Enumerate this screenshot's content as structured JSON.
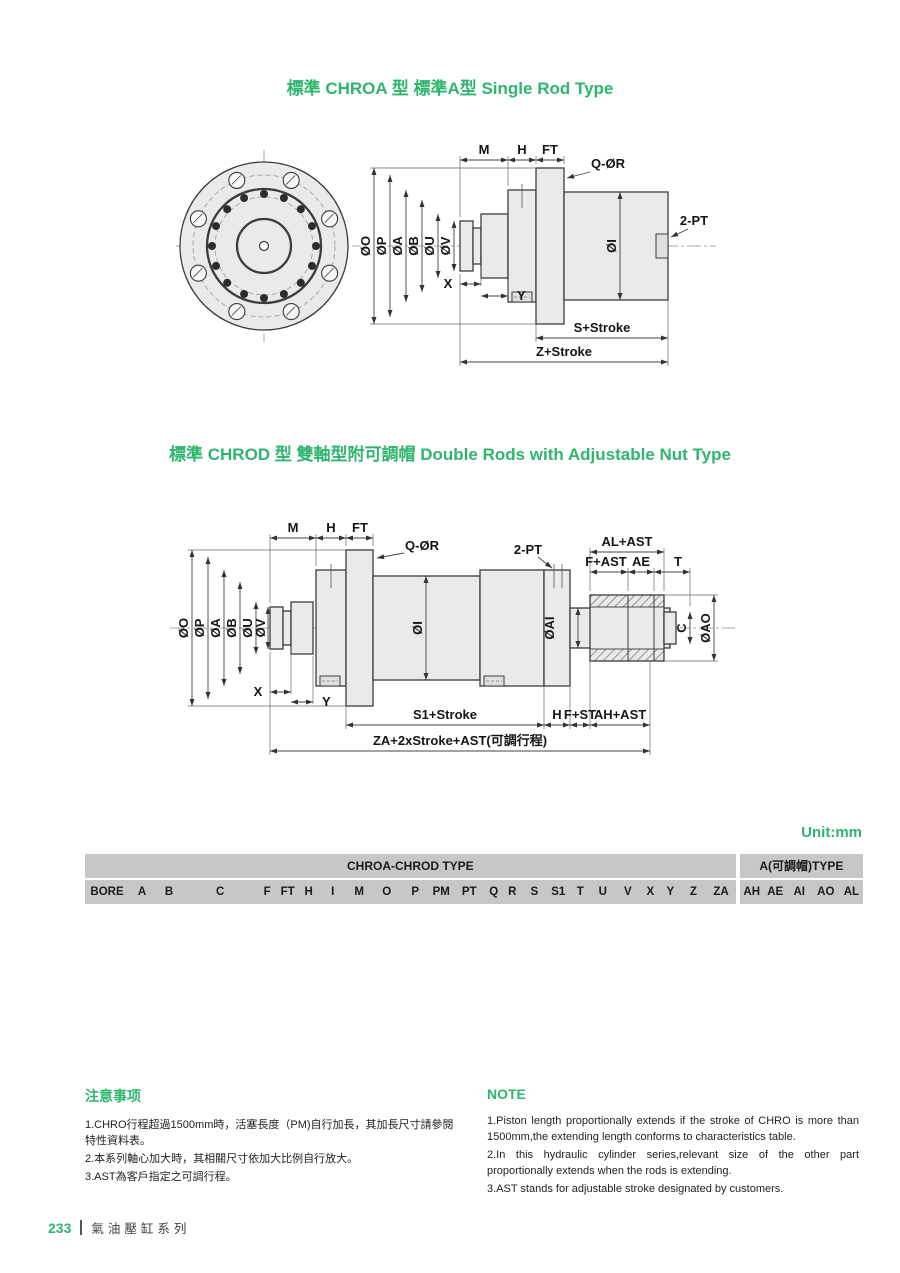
{
  "colors": {
    "accent_green": "#2fb56e",
    "table_header_bg": "#c7c7c7",
    "table_row_alt_bg": "#ebebeb"
  },
  "sections": {
    "title1": "標準 CHROA 型 標準A型 Single Rod Type",
    "title2": "標準 CHROD 型 雙軸型附可調帽 Double Rods with Adjustable Nut Type",
    "unit_label": "Unit:mm"
  },
  "drawing1": {
    "labels": {
      "m": "M",
      "h": "H",
      "ft": "FT",
      "q_or": "Q-ØR",
      "pt": "2-PT",
      "o_o": "ØO",
      "o_p": "ØP",
      "o_a": "ØA",
      "o_b": "ØB",
      "o_u": "ØU",
      "o_v": "ØV",
      "x": "X",
      "y": "Y",
      "o_i": "ØI",
      "s_stroke": "S+Stroke",
      "z_stroke": "Z+Stroke"
    }
  },
  "drawing2": {
    "labels": {
      "m": "M",
      "h": "H",
      "ft": "FT",
      "q_or": "Q-ØR",
      "pt": "2-PT",
      "al_ast": "AL+AST",
      "f_ast": "F+AST",
      "ae": "AE",
      "t": "T",
      "o_o": "ØO",
      "o_p": "ØP",
      "o_a": "ØA",
      "o_b": "ØB",
      "o_u": "ØU",
      "o_v": "ØV",
      "x": "X",
      "y": "Y",
      "o_i": "ØI",
      "o_ai": "ØAI",
      "c": "C",
      "o_ao": "ØAO",
      "s1_stroke": "S1+Stroke",
      "h_dim": "H",
      "f_st": "F+ST",
      "ah_ast": "AH+AST",
      "za_stroke": "ZA+2xStroke+AST(可調行程)"
    }
  },
  "table": {
    "group_headers": [
      "CHROA-CHROD TYPE",
      "A(可調帽)TYPE"
    ],
    "split_after": 24,
    "columns": [
      "BORE",
      "A",
      "B",
      "C",
      "F",
      "FT",
      "H",
      "I",
      "M",
      "O",
      "P",
      "PM",
      "PT",
      "Q",
      "R",
      "S",
      "S1",
      "T",
      "U",
      "V",
      "X",
      "Y",
      "Z",
      "ZA",
      "AH",
      "AE",
      "AI",
      "AO",
      "AL"
    ],
    "rows": [
      [
        "Φ125",
        "175",
        "60",
        "M50XP2.0",
        "25",
        "45",
        "50",
        "152",
        "80",
        "240",
        "210",
        "60",
        "3/4\"",
        "6",
        "18",
        "125",
        "100",
        "15",
        "60",
        "50",
        "15",
        "15",
        "255",
        "355",
        "50",
        "35",
        "70",
        "100",
        "60"
      ],
      [
        "Φ150",
        "200",
        "80",
        "M70XP2.0",
        "25",
        "50",
        "50",
        "180",
        "80",
        "280",
        "240",
        "60",
        "1\"",
        "6",
        "18",
        "130",
        "100",
        "20",
        "80",
        "70",
        "15",
        "15",
        "260",
        "365",
        "60",
        "40",
        "95",
        "120",
        "65"
      ],
      [
        "Φ180",
        "240",
        "100",
        "M90XP2.0",
        "30",
        "60",
        "60",
        "216",
        "100",
        "320",
        "280",
        "70",
        "1\"",
        "6",
        "18",
        "150",
        "110",
        "30",
        "95",
        "85",
        "25",
        "25",
        "310",
        "430",
        "70",
        "40",
        "120",
        "150",
        "70"
      ],
      [
        "Φ200",
        "260",
        "125",
        "M100XP2.0",
        "30",
        "65",
        "70",
        "242",
        "100",
        "350",
        "310",
        "70",
        "1.1/4\"",
        "6",
        "20",
        "155",
        "110",
        "30",
        "115",
        "100",
        "25",
        "25",
        "325",
        "450",
        "70",
        "40",
        "140",
        "180",
        "70"
      ],
      [
        "Φ225",
        "290",
        "140",
        "M120XP3.0",
        "30",
        "70",
        "70",
        "270",
        "120",
        "380",
        "340",
        "70",
        "1.1/4\"",
        "8",
        "20",
        "160",
        "110",
        "30",
        "135",
        "120",
        "25",
        "25",
        "350",
        "475",
        "75",
        "45",
        "160",
        "200",
        "75"
      ],
      [
        "Φ250",
        "330",
        "160",
        "M140XP3.0",
        "30",
        "75",
        "75",
        "298",
        "120",
        "440",
        "380",
        "70",
        "1.1/4\"",
        "8",
        "24",
        "170",
        "120",
        "35",
        "155",
        "140",
        "30",
        "30",
        "365",
        "505",
        "85",
        "50",
        "190",
        "240",
        "80"
      ],
      [
        "Φ280",
        "360",
        "180",
        "M160XP3.0",
        "30",
        "80",
        "80",
        "330",
        "150",
        "500",
        "430",
        "70",
        "1.1/2\"",
        "10",
        "26",
        "175",
        "120",
        "40",
        "175",
        "150",
        "30",
        "30",
        "405",
        "550",
        "90",
        "50",
        "210",
        "260",
        "80"
      ],
      [
        "Φ300",
        "380",
        "200",
        "M180XP3.0",
        "35",
        "85",
        "90",
        "350",
        "150",
        "550",
        "460",
        "90",
        "1.1/2\"",
        "10",
        "28",
        "200",
        "140",
        "40",
        "195",
        "170",
        "35",
        "35",
        "440",
        "605",
        "100",
        "60",
        "230",
        "290",
        "95"
      ]
    ]
  },
  "notes_cn": {
    "heading": "注意事项",
    "items": [
      "1.CHRO行程超過1500mm時，活塞長度（PM)自行加長，其加長尺寸請參閱特性資料表。",
      "2.本系列軸心加大時，其相關尺寸依加大比例自行放大。",
      "3.AST為客戶指定之可調行程。"
    ]
  },
  "notes_en": {
    "heading": "NOTE",
    "items": [
      "1.Piston length proportionally extends if the stroke of CHRO is more than 1500mm,the extending length conforms to characteristics table.",
      "2.In this hydraulic cylinder series,relevant size of the other part proportionally extends when the rods is extending.",
      "3.AST stands for adjustable stroke designated by customers."
    ]
  },
  "footer": {
    "page_number": "233",
    "series_title": "氣油壓缸系列"
  }
}
